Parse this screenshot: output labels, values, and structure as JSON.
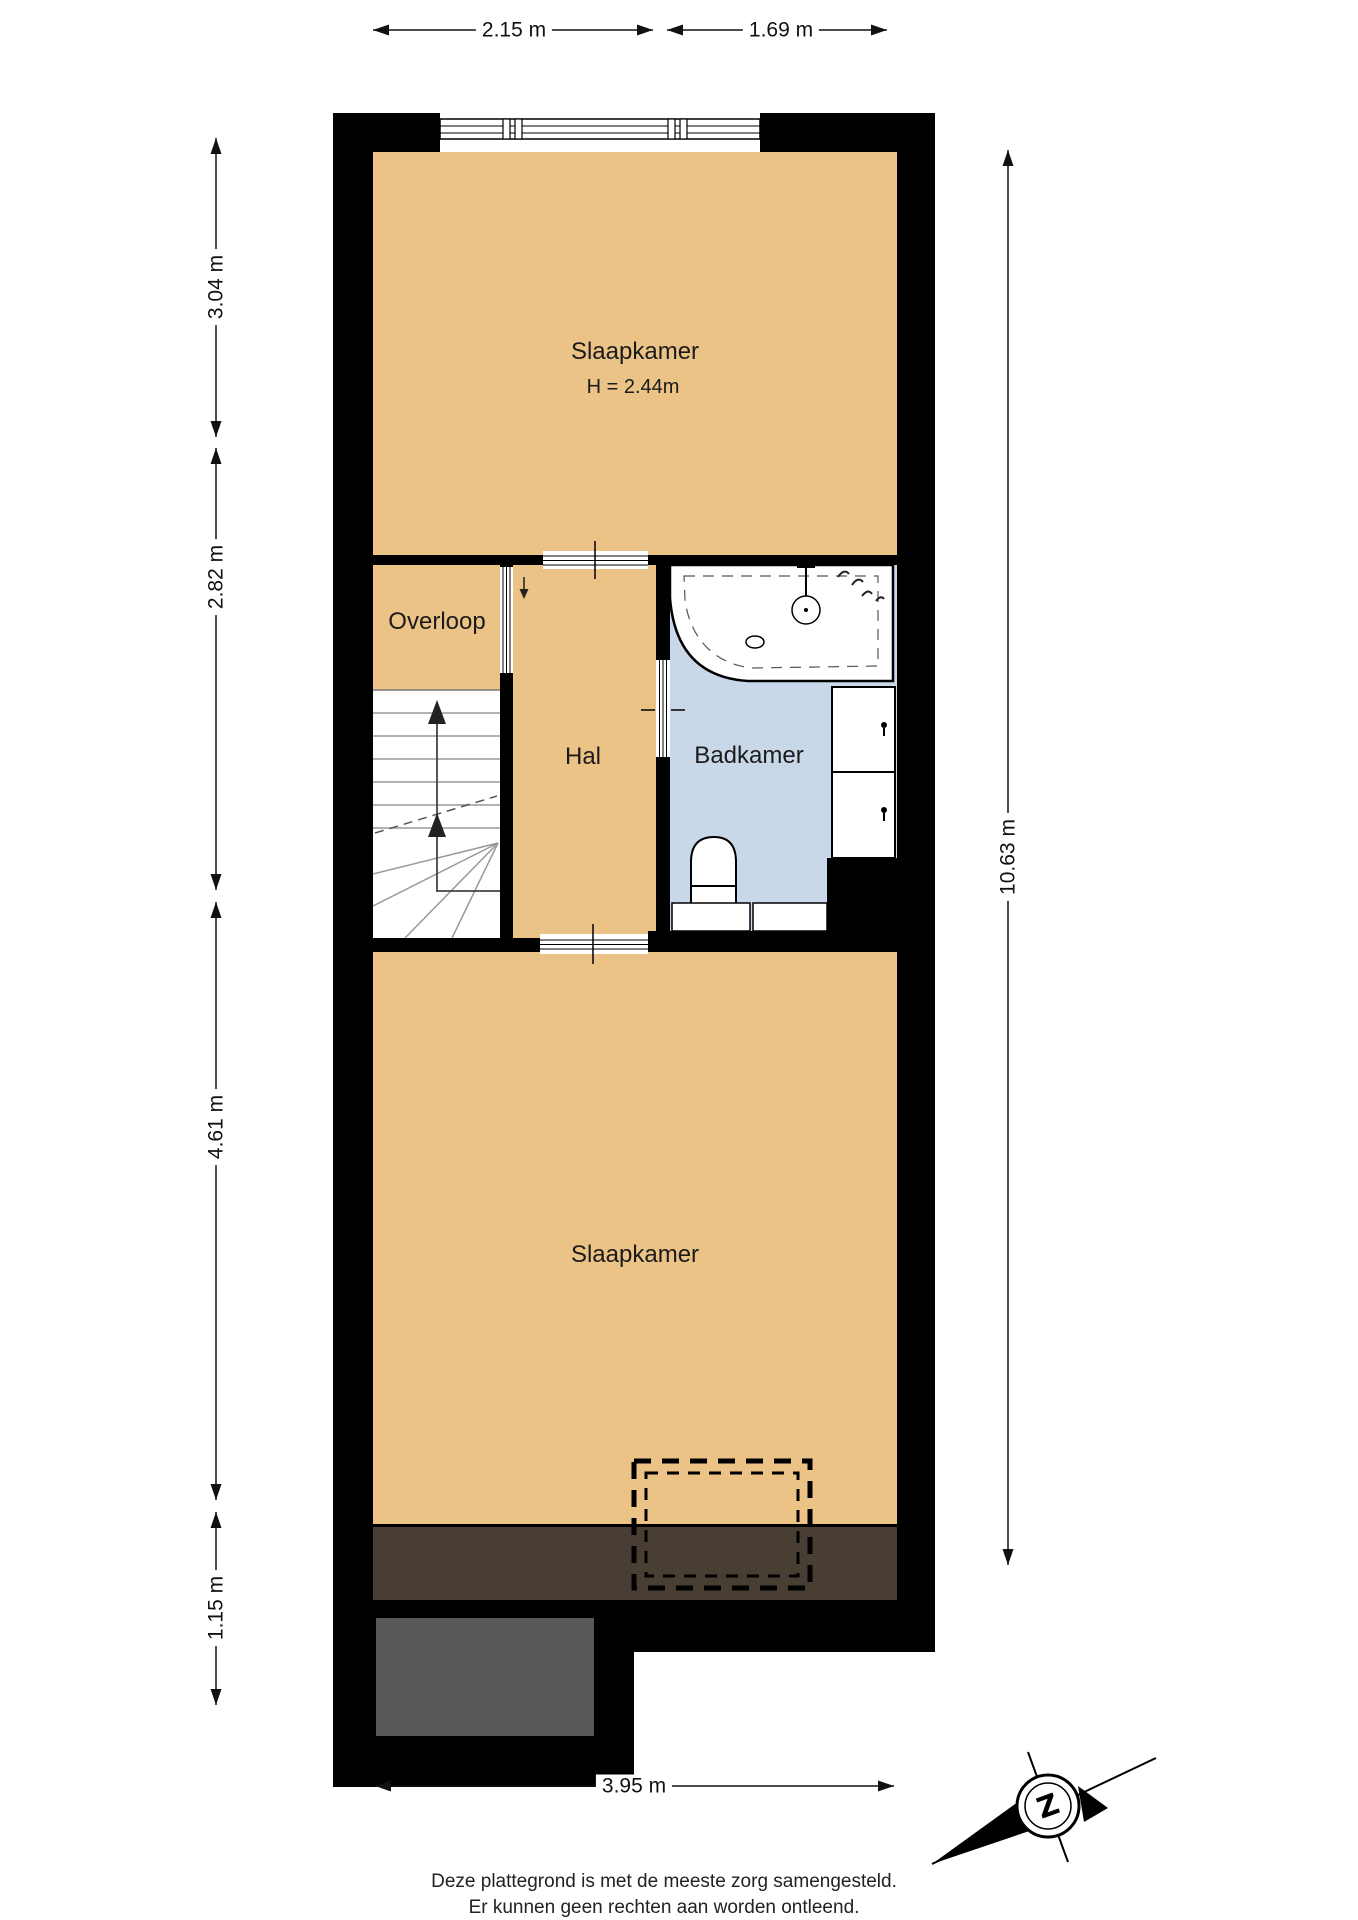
{
  "rooms": {
    "bedroom_top": {
      "label": "Slaapkamer",
      "height_note": "H = 2.44m"
    },
    "landing": {
      "label": "Overloop"
    },
    "hall": {
      "label": "Hal"
    },
    "bathroom": {
      "label": "Badkamer"
    },
    "bedroom_bottom": {
      "label": "Slaapkamer"
    }
  },
  "dimensions": {
    "top_width_left": "2.15 m",
    "top_width_right": "1.69 m",
    "left_top": "3.04 m",
    "left_middle": "2.82 m",
    "left_bottom": "4.61 m",
    "left_annex": "1.15 m",
    "right_total": "10.63 m",
    "bottom_width": "3.95 m"
  },
  "compass": {
    "north_label": "Z"
  },
  "footer": {
    "line1": "Deze plattegrond is met de meeste zorg samengesteld.",
    "line2": "Er kunnen geen rechten aan worden ontleend."
  },
  "colors": {
    "floor": "#ECC386",
    "bathroom_floor": "#C9D8E8",
    "wall": "#000000",
    "low_headroom": "#493E33",
    "annex_roof": "#585858"
  }
}
